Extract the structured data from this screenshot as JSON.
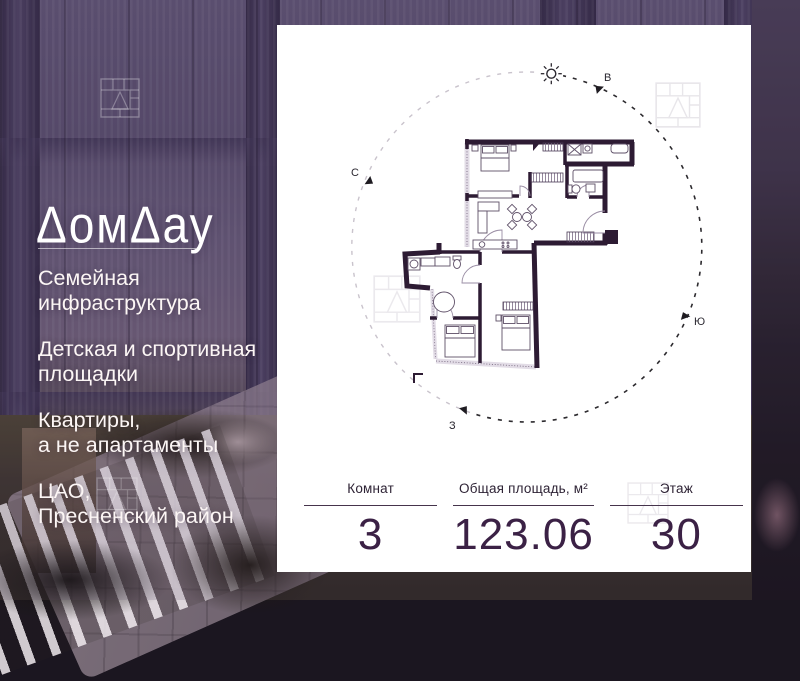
{
  "brand": {
    "name": "ДомДау",
    "logo_display": "ΔомΔау"
  },
  "features": [
    {
      "lines": [
        "Семейная",
        "инфраструктура"
      ]
    },
    {
      "lines": [
        "Детская и спортивная",
        "площадки"
      ]
    },
    {
      "lines": [
        "Квартиры,",
        "а не апартаменты"
      ]
    },
    {
      "lines": [
        "ЦАО,",
        "Пресненский район"
      ]
    }
  ],
  "stats": [
    {
      "label": "Комнат",
      "value": "3"
    },
    {
      "label": "Общая площадь, м²",
      "value": "123.06"
    },
    {
      "label": "Этаж",
      "value": "30"
    }
  ],
  "compass": {
    "north": "С",
    "east": "В",
    "south": "Ю",
    "west": "З"
  },
  "colors": {
    "accent_dark_purple": "#3b2145",
    "card_background": "#ffffff",
    "photo_text": "#fcf6f5",
    "plan_wall": "#2d1b33",
    "sun_path_dark": "#2c2a2e",
    "sun_path_light": "#c9c3cc"
  }
}
